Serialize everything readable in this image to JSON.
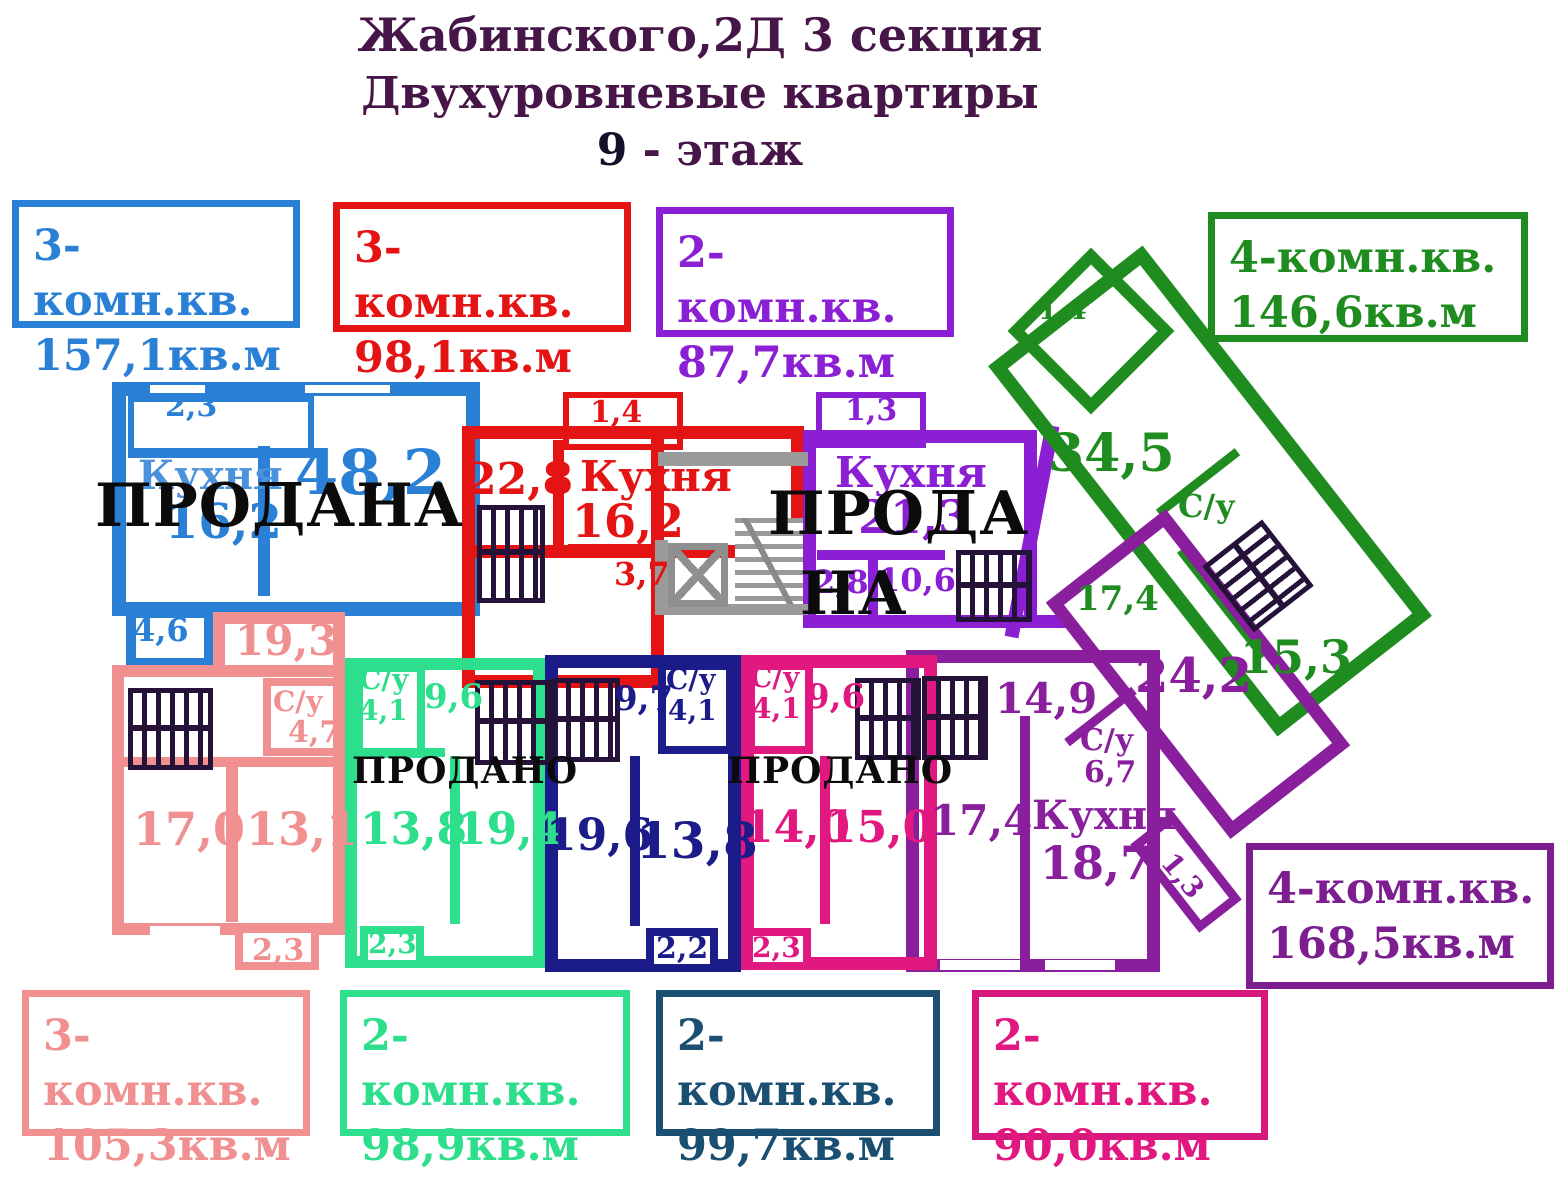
{
  "colors": {
    "title": "#471648",
    "blue": "#2a80d5",
    "red": "#e41414",
    "violet": "#8b1fd4",
    "green": "#1f8c1f",
    "salmon": "#f09090",
    "springgreen": "#2ddf8c",
    "navy_wall": "#1b1b8a",
    "navy_legend": "#1b4f72",
    "magenta": "#e0187f",
    "darkpurple": "#8a1f9e",
    "sold_text": "#0b0b0b",
    "common_gray": "#9a9a9a"
  },
  "title": {
    "line1": "Жабинского,2Д  3 секция",
    "line2": "Двухуровневые квартиры",
    "line3_num": "9",
    "line3_rest": " - этаж"
  },
  "legends": {
    "blue": {
      "type": "3-комн.кв.",
      "area": "157,1кв.м"
    },
    "red": {
      "type": "3-комн.кв.",
      "area": "98,1кв.м"
    },
    "violet": {
      "type": "2-комн.кв.",
      "area": "87,7кв.м"
    },
    "green": {
      "type": "4-комн.кв.",
      "area": "146,6кв.м"
    },
    "salmon": {
      "type": "3-комн.кв.",
      "area": "105,3кв.м"
    },
    "springgreen": {
      "type": "2-комн.кв.",
      "area": "98,9кв.м"
    },
    "navy": {
      "type": "2-комн.кв.",
      "area": "99,7кв.м"
    },
    "magenta": {
      "type": "2-комн.кв.",
      "area": "90,0кв.м"
    },
    "darkpurple": {
      "type": "4-комн.кв.",
      "area": "168,5кв.м"
    }
  },
  "plan": {
    "blue": {
      "balcony": "2,3",
      "kitchen": "Кухня",
      "kitchen_area": "16,2",
      "living": "48,2",
      "hall": "4,6",
      "sold": "ПРОДАНА"
    },
    "red": {
      "balcony": "1,4",
      "room": "22,8",
      "kitchen": "Кухня",
      "kitchen_area": "16,2",
      "hall": "3,7"
    },
    "violet": {
      "balcony": "1,3",
      "kitchen": "Кухня",
      "kitchen_area": "21,3",
      "hall": "2,8",
      "room": "10,6",
      "sold_line1": "ПРОДА",
      "sold_line2": "НА"
    },
    "green": {
      "balcony": "1,4",
      "living": "34,5",
      "wc": "С/у",
      "room1": "17,4",
      "room2": "15,3"
    },
    "salmon": {
      "room_top": "19,3",
      "wc": "С/у",
      "wc_area": "4,7",
      "room1": "17,0",
      "room2": "13,1",
      "balcony": "2,3"
    },
    "springgreen": {
      "wc": "С/у",
      "wc_area": "4,1",
      "hall": "9,6",
      "sold": "ПРОДАНО",
      "room1": "13,8",
      "room2": "19,4",
      "balcony": "2,3"
    },
    "navy": {
      "hall": "9,7",
      "wc": "С/у",
      "wc_area": "4,1",
      "room1": "19,6",
      "room2": "13,8",
      "balcony": "2,2"
    },
    "magenta": {
      "wc": "С/у",
      "wc_area": "4,1",
      "hall": "9,6",
      "sold": "ПРОДАНО",
      "room1": "14,0",
      "room2": "15,0",
      "balcony": "2,3"
    },
    "darkpurple": {
      "room_top": "14,9",
      "room1": "17,4",
      "wc": "С/у",
      "wc_area": "6,7",
      "kitchen": "Кухня",
      "kitchen_area": "18,7",
      "room_big": "24,2",
      "balcony": "1,3"
    }
  }
}
